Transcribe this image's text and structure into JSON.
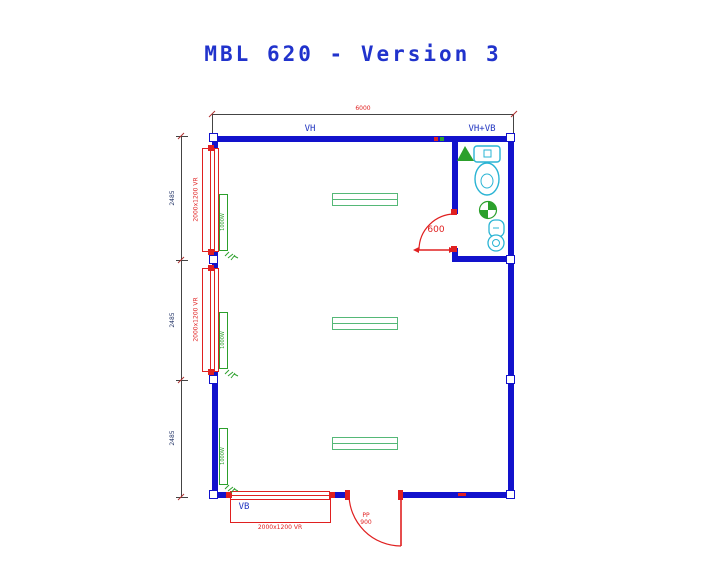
{
  "title": "MBL 620 - Version 3",
  "plan": {
    "overall_width_label": "6000",
    "zones": {
      "main_hall": "VH",
      "wet_room": "VH+VB",
      "bottom_zone": "VB"
    },
    "sections": [
      {
        "height_label": "2485"
      },
      {
        "height_label": "2485"
      },
      {
        "height_label": "2485"
      }
    ],
    "windows": [
      {
        "location": "left-top",
        "label": "2000x1200 VR"
      },
      {
        "location": "left-middle",
        "label": "2000x1200 VR"
      },
      {
        "location": "bottom",
        "label": "2000x1200 VR"
      }
    ],
    "doors": [
      {
        "location": "bottom-entrance",
        "type_label": "PP",
        "width_label": "900"
      },
      {
        "location": "wet-room",
        "width_label": "600"
      }
    ],
    "radiators": [
      {
        "power_label": "1000W"
      },
      {
        "power_label": "1000W"
      },
      {
        "power_label": "1000W"
      }
    ]
  },
  "colors": {
    "wall_blue": "#1212cc",
    "dimension_red": "#e02020",
    "fixture_cyan": "#2ab4d4",
    "equipment_green": "#2ca02c",
    "label_blue": "#2236c0",
    "title_blue": "#2133cc"
  }
}
